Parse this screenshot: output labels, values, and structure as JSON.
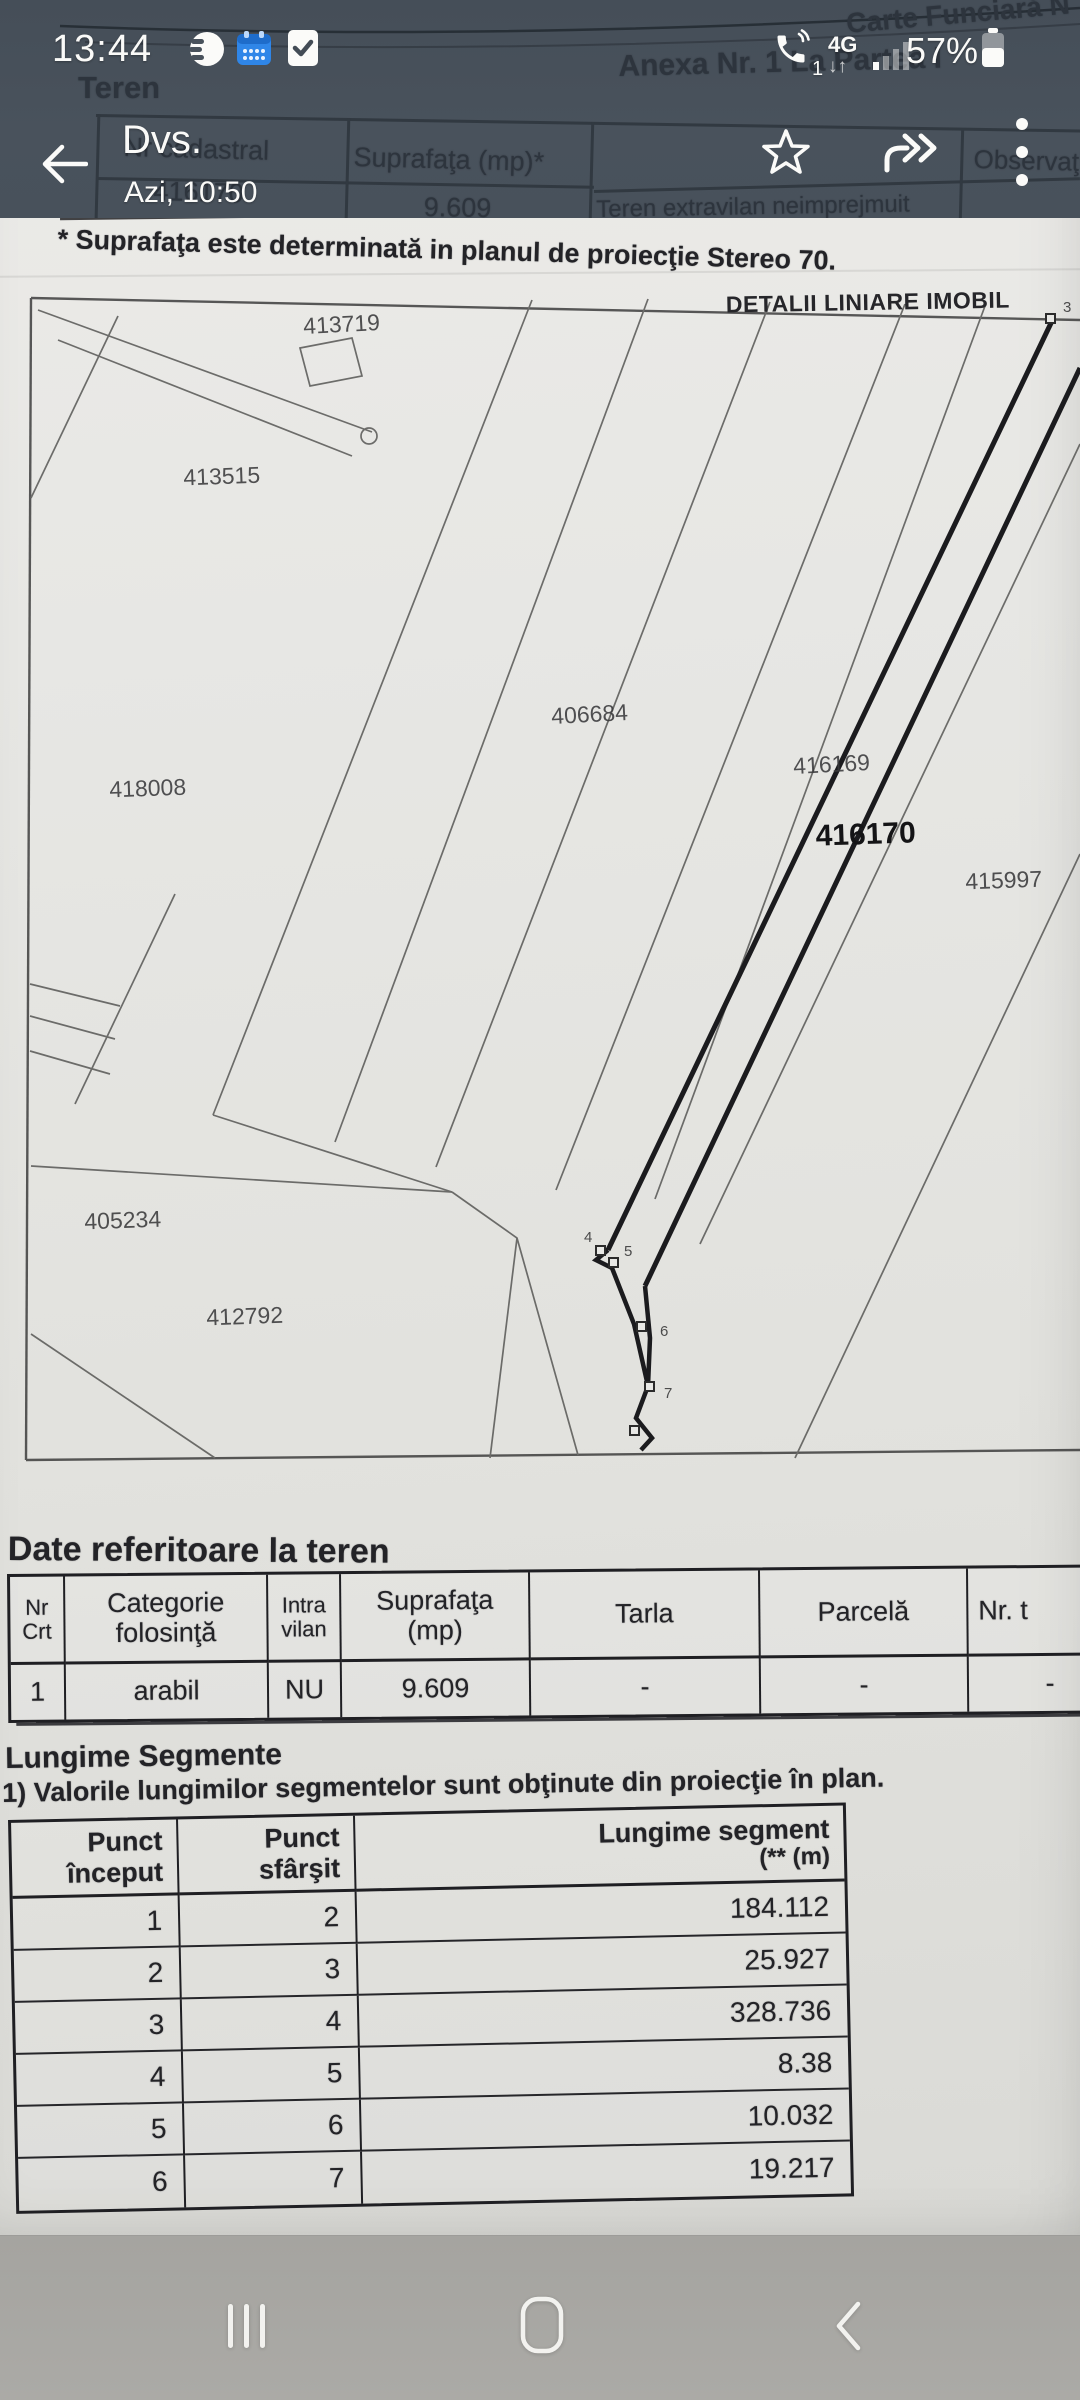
{
  "status_bar": {
    "time": "13:44",
    "battery": "57%",
    "network": "4G",
    "call_badge": "1"
  },
  "viewer_header": {
    "title": "Dvs.",
    "subtitle": "Azi, 10:50"
  },
  "document": {
    "carte_funciara": "Carte Funciară N",
    "anexa": "Anexa Nr. 1 La Partea I",
    "teren_heading": "Teren",
    "top_table": {
      "col1": "Nr cadastral",
      "col2": "Suprafaţa (mp)*",
      "col3": "Observaţii",
      "nr_cadastral": "416170",
      "suprafata": "9.609",
      "observatii": "Teren extravilan neimprejmuit"
    },
    "footnote": "* Suprafaţa este determinată in planul de proiecţie Stereo 70.",
    "map": {
      "title": "DETALII LINIARE IMOBIL",
      "parcels": [
        {
          "id": "413719"
        },
        {
          "id": "413515"
        },
        {
          "id": "406684"
        },
        {
          "id": "418008"
        },
        {
          "id": "416169"
        },
        {
          "id": "416170"
        },
        {
          "id": "415997"
        },
        {
          "id": "405234"
        },
        {
          "id": "412792"
        }
      ],
      "point_labels": [
        "3",
        "4",
        "5",
        "6",
        "7"
      ]
    },
    "land_section": {
      "heading": "Date referitoare la teren",
      "headers": [
        {
          "l1": "Nr",
          "l2": "Crt"
        },
        {
          "l1": "Categorie",
          "l2": "folosinţă"
        },
        {
          "l1": "Intra",
          "l2": "vilan"
        },
        {
          "l1": "Suprafaţa",
          "l2": "(mp)"
        },
        {
          "l1": "Tarla",
          "l2": ""
        },
        {
          "l1": "Parcelă",
          "l2": ""
        },
        {
          "l1": "Nr. t",
          "l2": ""
        }
      ],
      "row": [
        "1",
        "arabil",
        "NU",
        "9.609",
        "-",
        "-",
        "-"
      ]
    },
    "segments_section": {
      "heading": "Lungime Segmente",
      "note": "1) Valorile lungimilor segmentelor sunt obţinute din proiecţie în plan.",
      "headers": {
        "col1_l1": "Punct",
        "col1_l2": "început",
        "col2_l1": "Punct",
        "col2_l2": "sfârşit",
        "col3_l1": "Lungime segment",
        "col3_l2": "(** (m)"
      },
      "rows": [
        [
          "1",
          "2",
          "184.112"
        ],
        [
          "2",
          "3",
          "25.927"
        ],
        [
          "3",
          "4",
          "328.736"
        ],
        [
          "4",
          "5",
          "8.38"
        ],
        [
          "5",
          "6",
          "10.032"
        ],
        [
          "6",
          "7",
          "19.217"
        ]
      ]
    }
  }
}
